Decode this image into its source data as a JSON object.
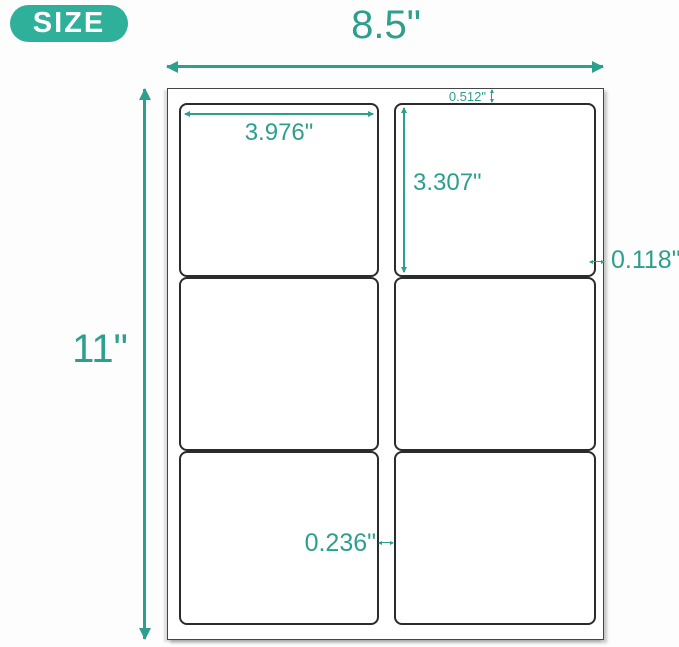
{
  "badge": {
    "label": "SIZE"
  },
  "diagram": {
    "title": "label sheet size diagram",
    "sheet_width_label": "8.5\"",
    "sheet_height_label": "11\"",
    "label_width": "3.976\"",
    "label_height": "3.307\"",
    "top_margin": "0.512\"",
    "side_margin": "0.118\"",
    "center_gap": "0.236\"",
    "grid": {
      "rows": 3,
      "columns": 2,
      "labels_total": 6
    }
  },
  "colors": {
    "accent": "#2d9f8d",
    "badge_bg": "#2fb09b",
    "badge_text": "#ffffff",
    "sheet_border": "#454545",
    "label_border": "#2b2b2b",
    "canvas_bg": "#fdfdfd"
  }
}
